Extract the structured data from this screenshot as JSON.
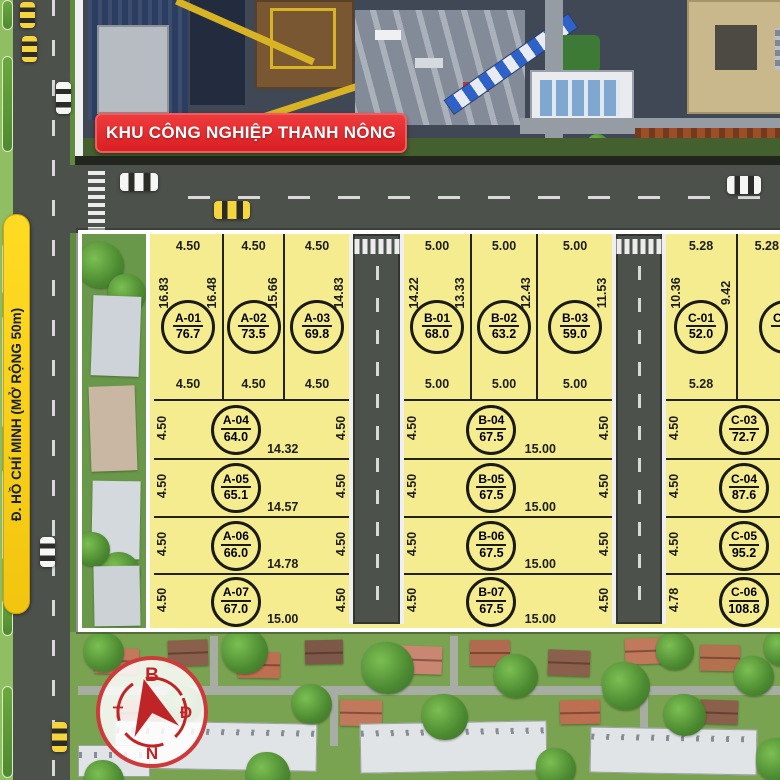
{
  "aerial": {
    "banner": "KHU CÔNG NGHIỆP THANH NÔNG"
  },
  "road_label": "Đ. HỒ CHÍ MINH (MỞ RỘNG 50m)",
  "compass": {
    "north": "B",
    "east": "Đ",
    "south": "N",
    "west": "T"
  },
  "colors": {
    "plot_yellow": "#f5ec90",
    "banner_red": "#d91f23",
    "label_yellow": "#ffd91f",
    "road_gray": "#4d514c"
  },
  "blocks": [
    {
      "name": "A",
      "plots": [
        {
          "id": "A-01",
          "area": "76.7",
          "top": "4.50",
          "bottom": "4.50",
          "left": "16.83",
          "right": "16.48"
        },
        {
          "id": "A-02",
          "area": "73.5",
          "top": "4.50",
          "bottom": "4.50",
          "right": "15.66"
        },
        {
          "id": "A-03",
          "area": "69.8",
          "top": "4.50",
          "bottom": "4.50",
          "right": "14.83"
        },
        {
          "id": "A-04",
          "area": "64.0",
          "left": "4.50",
          "right": "4.50",
          "bottom": "14.32"
        },
        {
          "id": "A-05",
          "area": "65.1",
          "left": "4.50",
          "right": "4.50",
          "bottom": "14.57"
        },
        {
          "id": "A-06",
          "area": "66.0",
          "left": "4.50",
          "right": "4.50",
          "bottom": "14.78"
        },
        {
          "id": "A-07",
          "area": "67.0",
          "left": "4.50",
          "right": "4.50",
          "bottom": "15.00"
        }
      ]
    },
    {
      "name": "B",
      "plots": [
        {
          "id": "B-01",
          "area": "68.0",
          "top": "5.00",
          "bottom": "5.00",
          "left": "14.22",
          "right": "13.33"
        },
        {
          "id": "B-02",
          "area": "63.2",
          "top": "5.00",
          "bottom": "5.00",
          "right": "12.43"
        },
        {
          "id": "B-03",
          "area": "59.0",
          "top": "5.00",
          "bottom": "5.00",
          "right": "11.53"
        },
        {
          "id": "B-04",
          "area": "67.5",
          "left": "4.50",
          "right": "4.50",
          "bottom": "15.00"
        },
        {
          "id": "B-05",
          "area": "67.5",
          "left": "4.50",
          "right": "4.50",
          "bottom": "15.00"
        },
        {
          "id": "B-06",
          "area": "67.5",
          "left": "4.50",
          "right": "4.50",
          "bottom": "15.00"
        },
        {
          "id": "B-07",
          "area": "67.5",
          "left": "4.50",
          "right": "4.50",
          "bottom": "15.00"
        }
      ]
    },
    {
      "name": "C",
      "plots": [
        {
          "id": "C-01",
          "area": "52.0",
          "top": "5.28",
          "bottom": "5.28",
          "left": "10.36",
          "right": "9.42"
        },
        {
          "id": "C-02",
          "area": "6",
          "top": "5.28"
        },
        {
          "id": "C-03",
          "area": "72.7",
          "left": "4.50"
        },
        {
          "id": "C-04",
          "area": "87.6",
          "left": "4.50"
        },
        {
          "id": "C-05",
          "area": "95.2",
          "left": "4.50"
        },
        {
          "id": "C-06",
          "area": "108.8",
          "left": "4.78"
        }
      ]
    }
  ]
}
